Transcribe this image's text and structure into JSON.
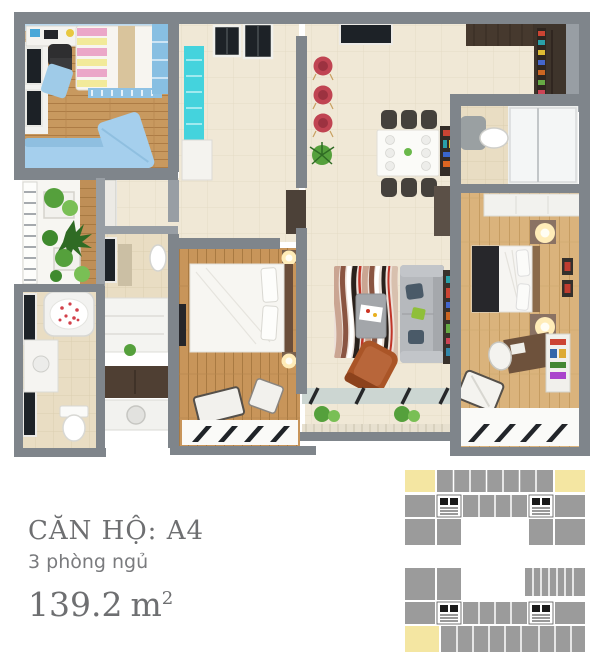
{
  "unit_info": {
    "title": "CĂN HỘ: A4",
    "bedrooms": "3 phòng ngủ",
    "area_value": "139.2",
    "area_unit": "m",
    "area_exponent": "2"
  },
  "palette": {
    "text_gray": "#6e6f71",
    "wall_gray": "#7f858b",
    "wall_light": "#989ea4",
    "floor_cream": "#f0e8d6",
    "wood_kids": "#c8995f",
    "wood_bedroom": "#c8955a",
    "wood_master": "#dab37c",
    "blue_furniture": "#a5cfed",
    "cyan_cabinet": "#44d3dd",
    "kitchen_brown": "#3e342b",
    "sofa_gray": "#b6b9bd",
    "armchair_orange": "#aa5527",
    "plate_red": "#c04452",
    "rug_red": "#c03428",
    "plant_green": "#55a03c",
    "lamp_glow": "#ffecb8",
    "keyplan_gray": "#9b9b9b",
    "keyplan_yellow": "#f4e6a2"
  }
}
